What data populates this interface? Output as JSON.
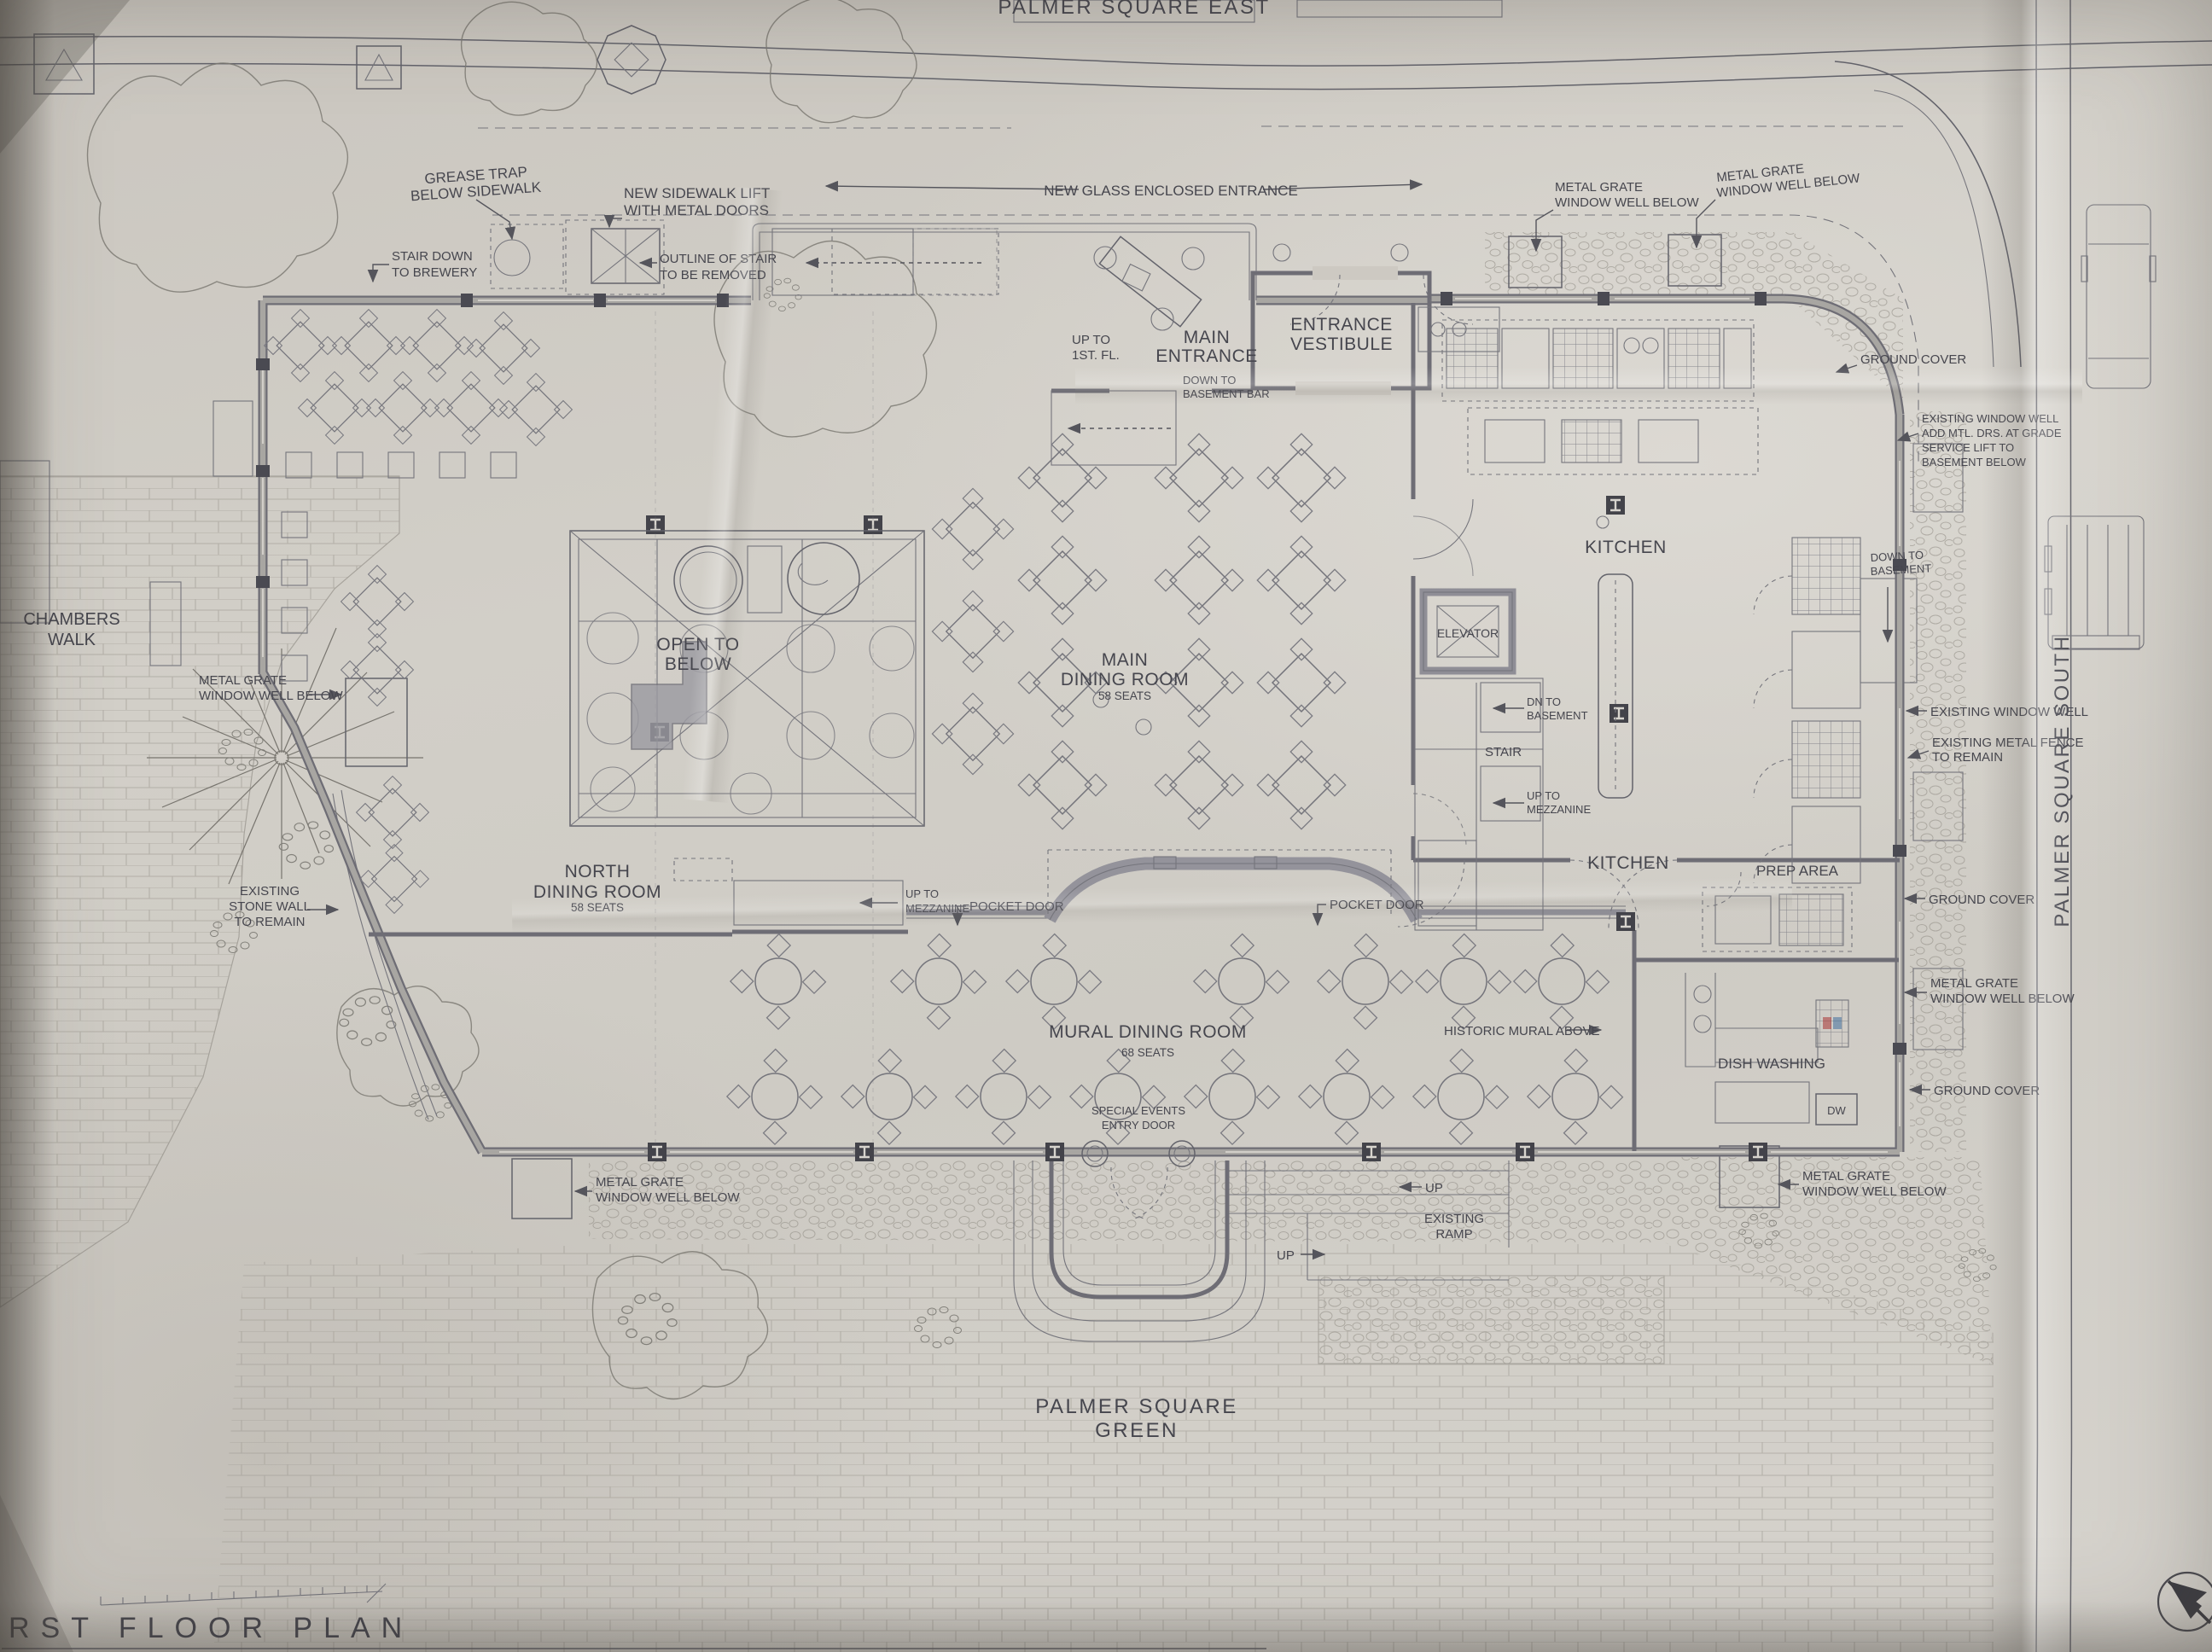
{
  "sheet": {
    "title": "RST FLOOR PLAN"
  },
  "streets": {
    "east": "PALMER SQUARE EAST",
    "south": "PALMER SQUARE SOUTH",
    "green": [
      "PALMER SQUARE",
      "GREEN"
    ],
    "chambers": [
      "CHAMBERS",
      "WALK"
    ]
  },
  "rooms": {
    "main_entrance": [
      "MAIN",
      "ENTRANCE"
    ],
    "entrance_vestibule": [
      "ENTRANCE",
      "VESTIBULE"
    ],
    "main_dining": [
      "MAIN",
      "DINING ROOM"
    ],
    "main_dining_seats": "58 SEATS",
    "north_dining": [
      "NORTH",
      "DINING ROOM"
    ],
    "north_dining_seats": "58 SEATS",
    "mural_dining": "MURAL DINING ROOM",
    "mural_dining_seats": "68 SEATS",
    "open_below": [
      "OPEN TO",
      "BELOW"
    ],
    "kitchen": "KITCHEN",
    "elevator": "ELEVATOR",
    "stair": "STAIR",
    "prep_area": "PREP AREA",
    "dish_washing": "DISH WASHING",
    "dw": "DW"
  },
  "annotations": {
    "grease_trap": [
      "GREASE TRAP",
      "BELOW SIDEWALK"
    ],
    "sidewalk_lift": [
      "NEW SIDEWALK LIFT",
      "WITH METAL DOORS"
    ],
    "stair_brewery": [
      "STAIR DOWN",
      "TO BREWERY"
    ],
    "outline_stair": [
      "OUTLINE OF STAIR",
      "TO BE REMOVED"
    ],
    "glass_entrance": "NEW GLASS ENCLOSED ENTRANCE",
    "up_1st": [
      "UP TO",
      "1ST. FL."
    ],
    "down_bsmt_bar": [
      "DOWN TO",
      "BASEMENT BAR"
    ],
    "metal_grate": [
      "METAL GRATE",
      "WINDOW WELL BELOW"
    ],
    "ground_cover": "GROUND COVER",
    "exist_well_lift": [
      "EXISTING WINDOW WELL",
      "ADD MTL. DRS. AT GRADE",
      "SERVICE LIFT TO",
      "BASEMENT BELOW"
    ],
    "down_basement": [
      "DOWN TO",
      "BASEMENT"
    ],
    "dn_basement": [
      "DN TO",
      "BASEMENT"
    ],
    "up_mezz": [
      "UP TO",
      "MEZZANINE"
    ],
    "exist_window_well": "EXISTING WINDOW WELL",
    "exist_fence": [
      "EXISTING METAL FENCE",
      "TO REMAIN"
    ],
    "exist_stone": [
      "EXISTING",
      "STONE WALL",
      "TO REMAIN"
    ],
    "pocket_door": "POCKET DOOR",
    "historic_mural": "HISTORIC MURAL ABOVE",
    "special_events": [
      "SPECIAL EVENTS",
      "ENTRY DOOR"
    ],
    "up": "UP",
    "existing_ramp": [
      "EXISTING",
      "RAMP"
    ]
  },
  "colors": {
    "paper": "#cdc9c2",
    "ink": "#63636b",
    "wall_poche": "#8f8e96",
    "text": "#46464e"
  }
}
